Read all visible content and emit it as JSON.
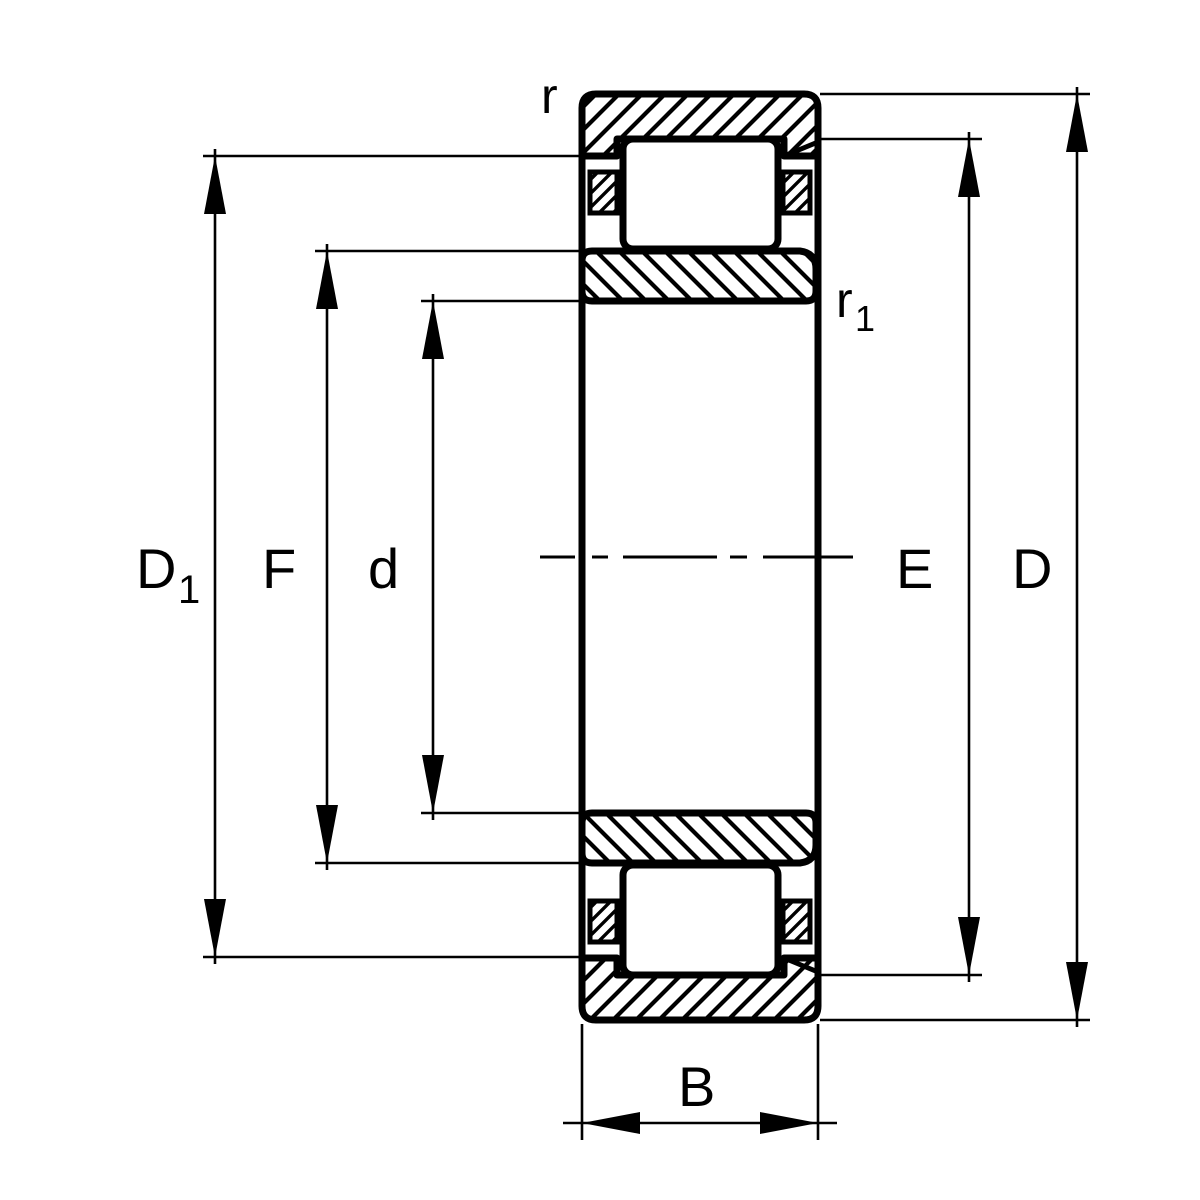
{
  "drawing": {
    "description": "Sectional drawing of a cylindrical roller bearing with dimension annotations",
    "colors": {
      "ink": "#000000",
      "background": "#ffffff"
    }
  },
  "labels": {
    "bore_shoulder_diameter": {
      "base": "D",
      "sub": "1"
    },
    "inner_raceway_diameter": "F",
    "bore_diameter": "d",
    "outer_raceway_diameter": "E",
    "outside_diameter": "D",
    "outer_chamfer": "r",
    "inner_chamfer": {
      "base": "r",
      "sub": "1"
    },
    "width": "B"
  }
}
